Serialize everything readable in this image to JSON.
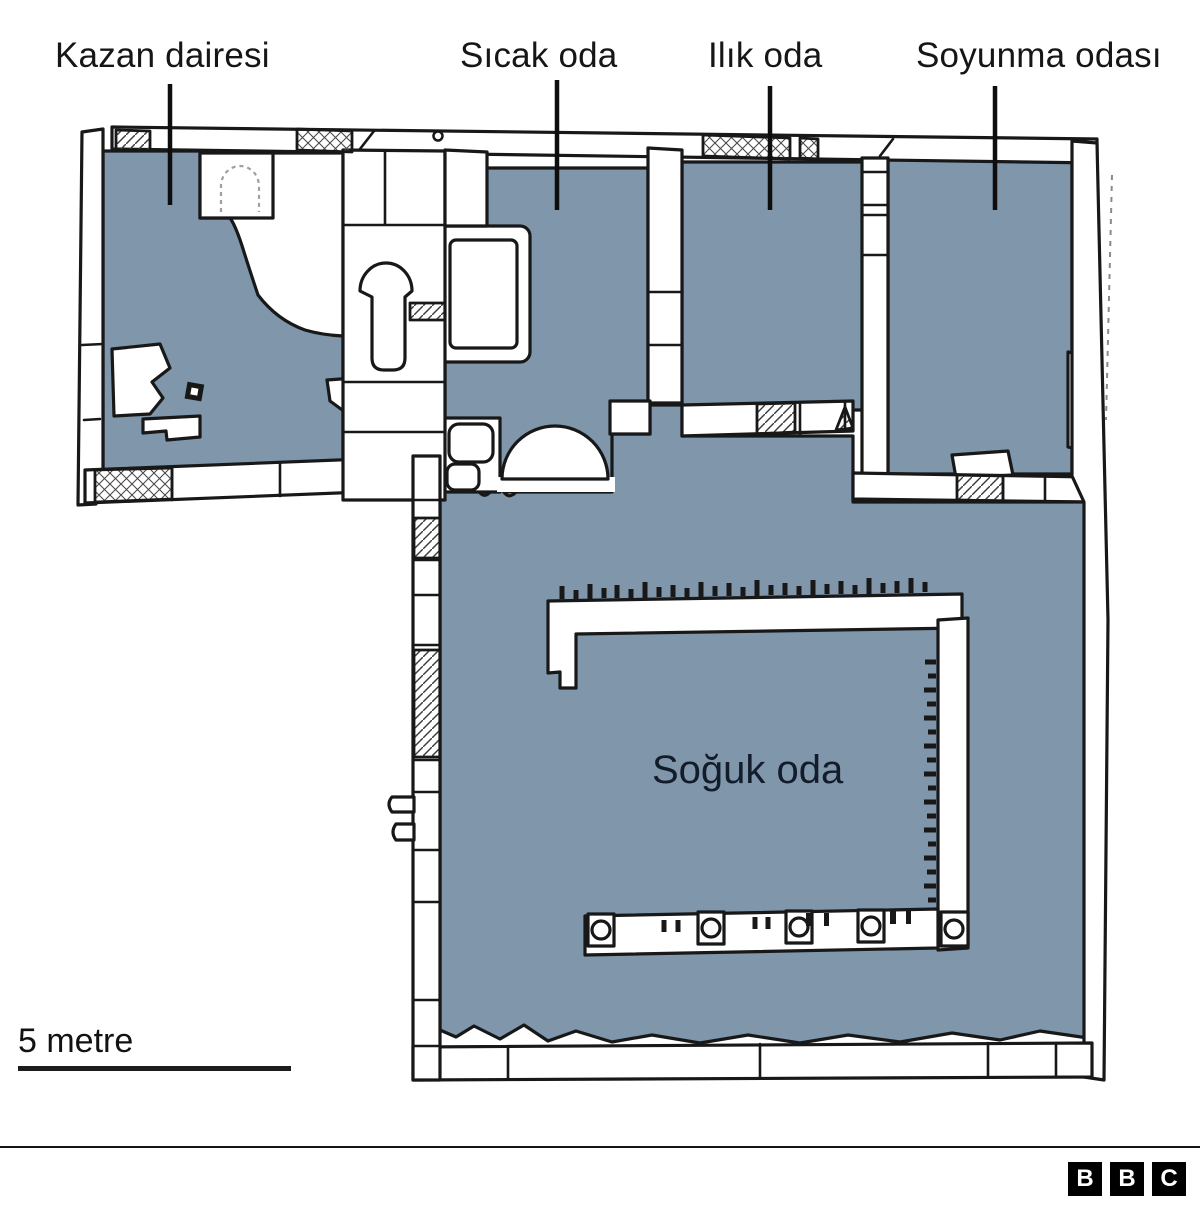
{
  "figure": {
    "type": "floor-plan-infographic",
    "room_labels": [
      {
        "id": "kazan-dairesi",
        "label": "Kazan dairesi"
      },
      {
        "id": "sicak-oda",
        "label": "Sıcak oda"
      },
      {
        "id": "ilik-oda",
        "label": "Ilık oda"
      },
      {
        "id": "soyunma-odasi",
        "label": "Soyunma odası"
      }
    ],
    "inner_label": "Soğuk oda",
    "scale_label": "5 metre",
    "brand_letters": [
      "B",
      "B",
      "C"
    ]
  },
  "colors": {
    "room-fill": "#7F96AB",
    "line": "#181818",
    "label-text": "#161616",
    "inner-text": "#131C2B",
    "brand-bg": "#000000",
    "brand-text": "#ffffff"
  }
}
